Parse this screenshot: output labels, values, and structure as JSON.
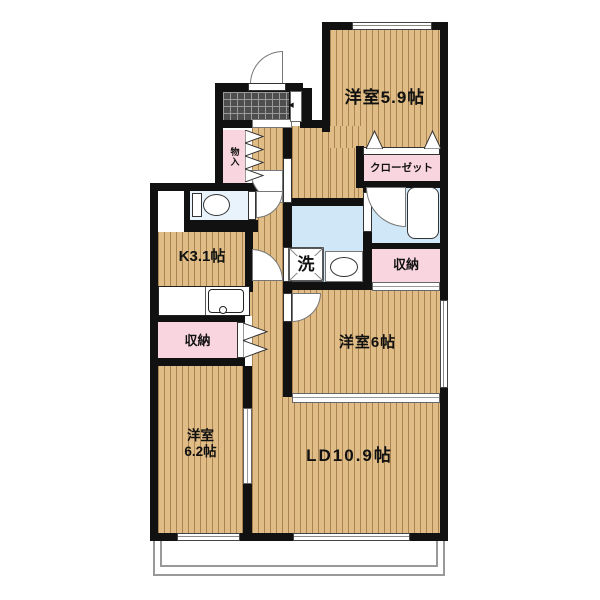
{
  "plan": {
    "labels": {
      "bedroom59": "洋室5.9帖",
      "closet": "クローゼット",
      "kitchen": "K3.1帖",
      "wash": "洗",
      "storage_right": "収納",
      "storage_left": "収納",
      "mono_ire": "物入",
      "bedroom6": "洋室6帖",
      "bedroom62_line1": "洋室",
      "bedroom62_line2": "6.2帖",
      "living_dining": "LD10.9帖",
      "entry_arrow": "◀"
    },
    "colors": {
      "wall": "#111111",
      "wood_floor": "#e0bc86",
      "wood_stripe": "#7d5523",
      "storage_pink": "#f9d5e0",
      "wet_area_blue": "#cfe7f6",
      "toilet_blue": "#e8f3fb",
      "entrance_tile": "#4e4e4e",
      "balcony_line": "#999999"
    }
  }
}
